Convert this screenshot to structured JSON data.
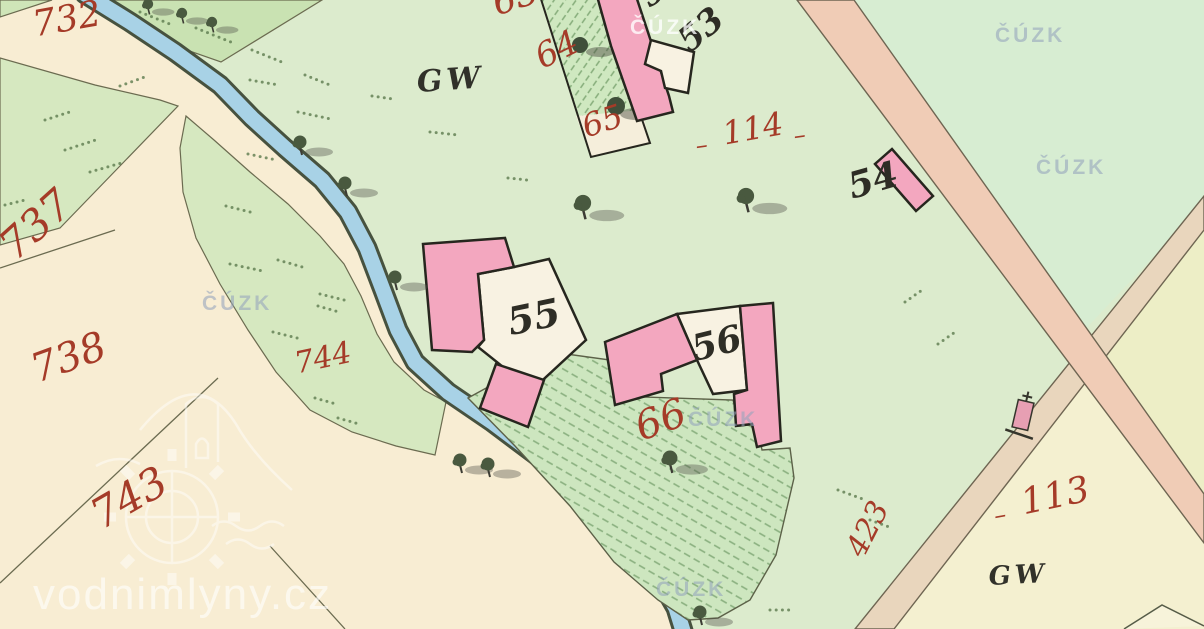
{
  "map": {
    "title": "Historical cadastral map sheet",
    "red_parcel_labels": [
      {
        "text": "732",
        "x": 30,
        "y": 8,
        "size": 36,
        "rot": -10
      },
      {
        "text": "737",
        "x": -8,
        "y": 236,
        "size": 42,
        "rot": -42
      },
      {
        "text": "738",
        "x": 26,
        "y": 352,
        "size": 40,
        "rot": -20
      },
      {
        "text": "743",
        "x": 84,
        "y": 500,
        "size": 42,
        "rot": -30
      },
      {
        "text": "744",
        "x": 292,
        "y": 350,
        "size": 30,
        "rot": -12
      },
      {
        "text": "63",
        "x": 488,
        "y": -12,
        "size": 36,
        "rot": -18
      },
      {
        "text": "64",
        "x": 530,
        "y": 44,
        "size": 34,
        "rot": -26
      },
      {
        "text": "65",
        "x": 578,
        "y": 112,
        "size": 32,
        "rot": -18
      },
      {
        "text": "66",
        "x": 630,
        "y": 410,
        "size": 40,
        "rot": -20
      },
      {
        "text": "114",
        "x": 720,
        "y": 118,
        "size": 32,
        "rot": -10
      },
      {
        "text": "113",
        "x": 1018,
        "y": 486,
        "size": 36,
        "rot": -12
      },
      {
        "text": "423",
        "x": 842,
        "y": 548,
        "size": 30,
        "rot": -63
      },
      {
        "text": "–",
        "x": 694,
        "y": 134,
        "size": 24,
        "rot": -8
      },
      {
        "text": "–",
        "x": 792,
        "y": 124,
        "size": 24,
        "rot": -8
      },
      {
        "text": "–",
        "x": 992,
        "y": 504,
        "size": 24,
        "rot": -10
      }
    ],
    "black_house_labels": [
      {
        "text": "52",
        "x": 634,
        "y": -14,
        "size": 32,
        "rot": -35
      },
      {
        "text": "53",
        "x": 672,
        "y": 32,
        "size": 34,
        "rot": -40
      },
      {
        "text": "54",
        "x": 844,
        "y": 170,
        "size": 36,
        "rot": -16
      },
      {
        "text": "55",
        "x": 504,
        "y": 304,
        "size": 38,
        "rot": -12
      },
      {
        "text": "56",
        "x": 688,
        "y": 332,
        "size": 36,
        "rot": -14
      }
    ],
    "landuse_labels": [
      {
        "text": "GW",
        "x": 416,
        "y": 68,
        "size": 30,
        "rot": -4
      },
      {
        "text": "GW",
        "x": 988,
        "y": 564,
        "size": 26,
        "rot": -3
      }
    ],
    "watermarks": {
      "cuzk_text": "ČÚZK",
      "cuzk_positions": [
        {
          "x": 995,
          "y": 24,
          "style": "gray"
        },
        {
          "x": 1036,
          "y": 156,
          "style": "gray"
        },
        {
          "x": 202,
          "y": 292,
          "style": "gray"
        },
        {
          "x": 688,
          "y": 408,
          "style": "gray"
        },
        {
          "x": 656,
          "y": 578,
          "style": "gray"
        },
        {
          "x": 630,
          "y": 16,
          "style": "white"
        }
      ],
      "site_text": "vodnimlyny.cz",
      "site_x": 33,
      "site_y": 570
    },
    "colors": {
      "meadow_green": "#dcebcd",
      "field_cream": "#f8edd3",
      "building_pink": "#f3a7bf",
      "stream_blue": "#a8d2e6",
      "road_tan": "#f0ccb6",
      "parcel_number_red": "#a53b28",
      "house_number_black": "#2e2d25"
    }
  }
}
